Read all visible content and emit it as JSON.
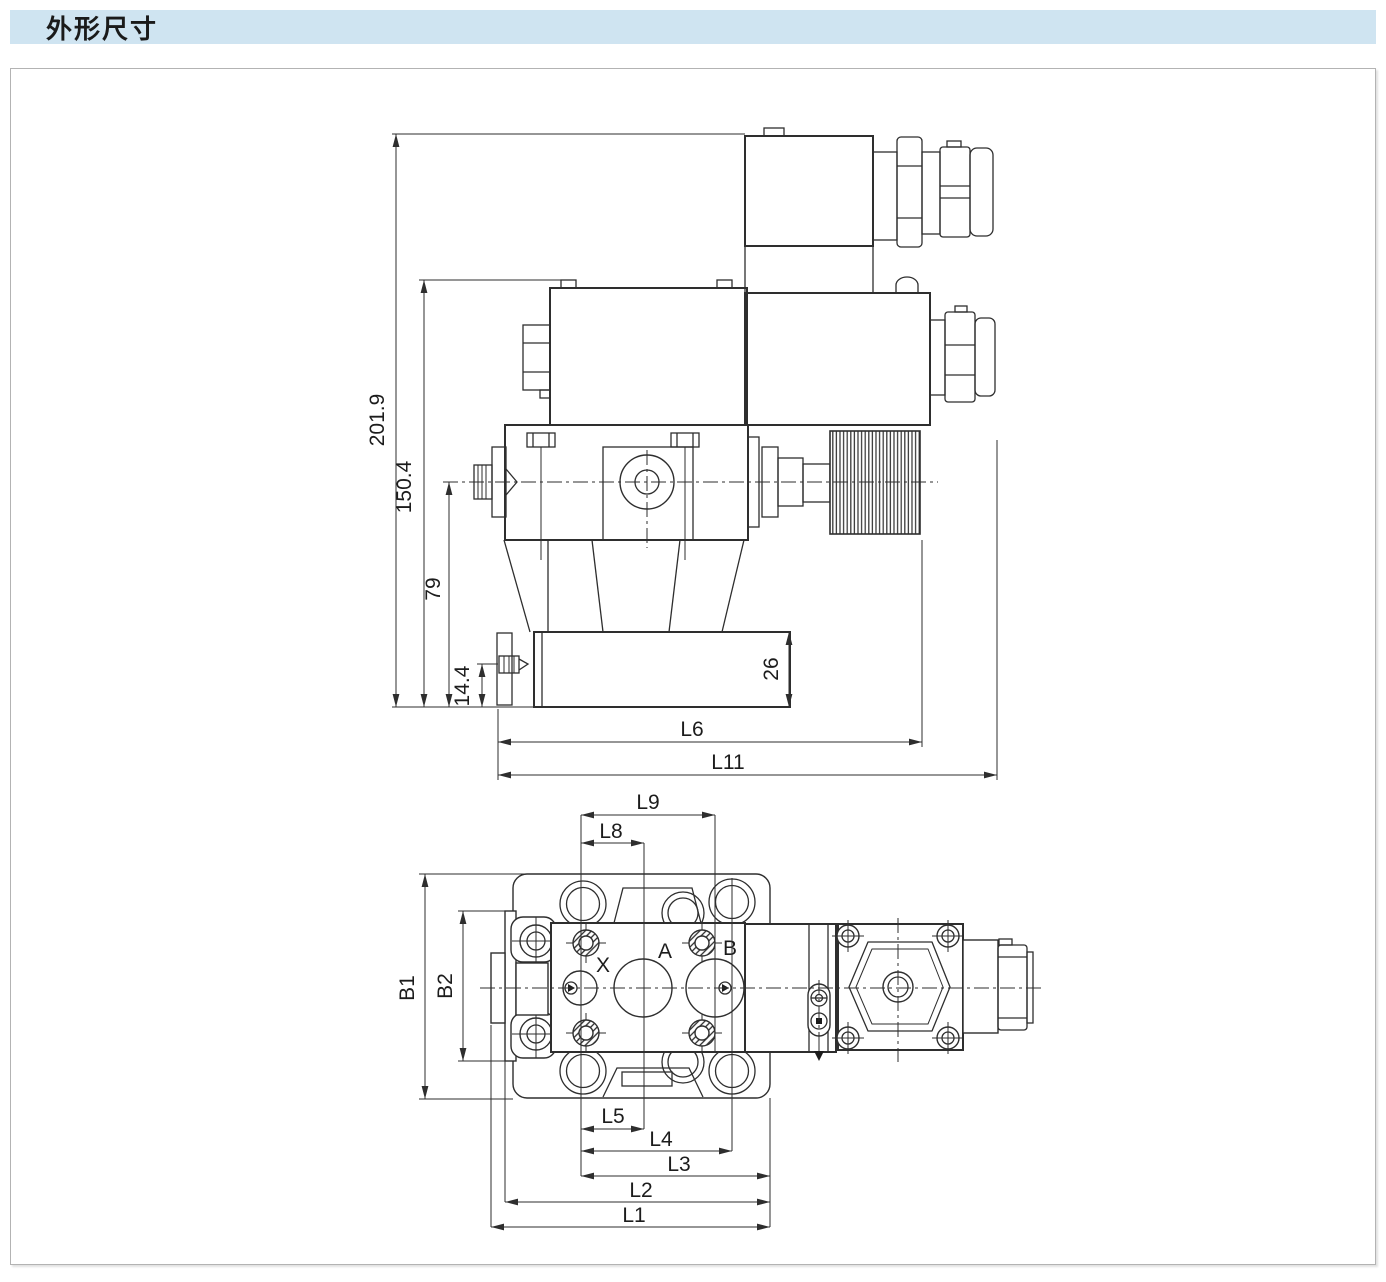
{
  "page": {
    "title": "外形尺寸",
    "header_bg": "#cfe4f1",
    "line_color": "#2e2e2e"
  },
  "diagram": {
    "side_view": {
      "dims": {
        "overall_height": "201.9",
        "coil_top_height": "150.4",
        "centerline_height": "79",
        "foot_bolt_height": "14.4",
        "base_thickness": "26",
        "l6": "L6",
        "l11": "L11"
      }
    },
    "top_view": {
      "ports": {
        "x": "X",
        "a": "A",
        "b": "B"
      },
      "dims": {
        "l9": "L9",
        "l8": "L8",
        "b1": "B1",
        "b2": "B2",
        "l5": "L5",
        "l4": "L4",
        "l3": "L3",
        "l2": "L2",
        "l1": "L1"
      }
    }
  }
}
